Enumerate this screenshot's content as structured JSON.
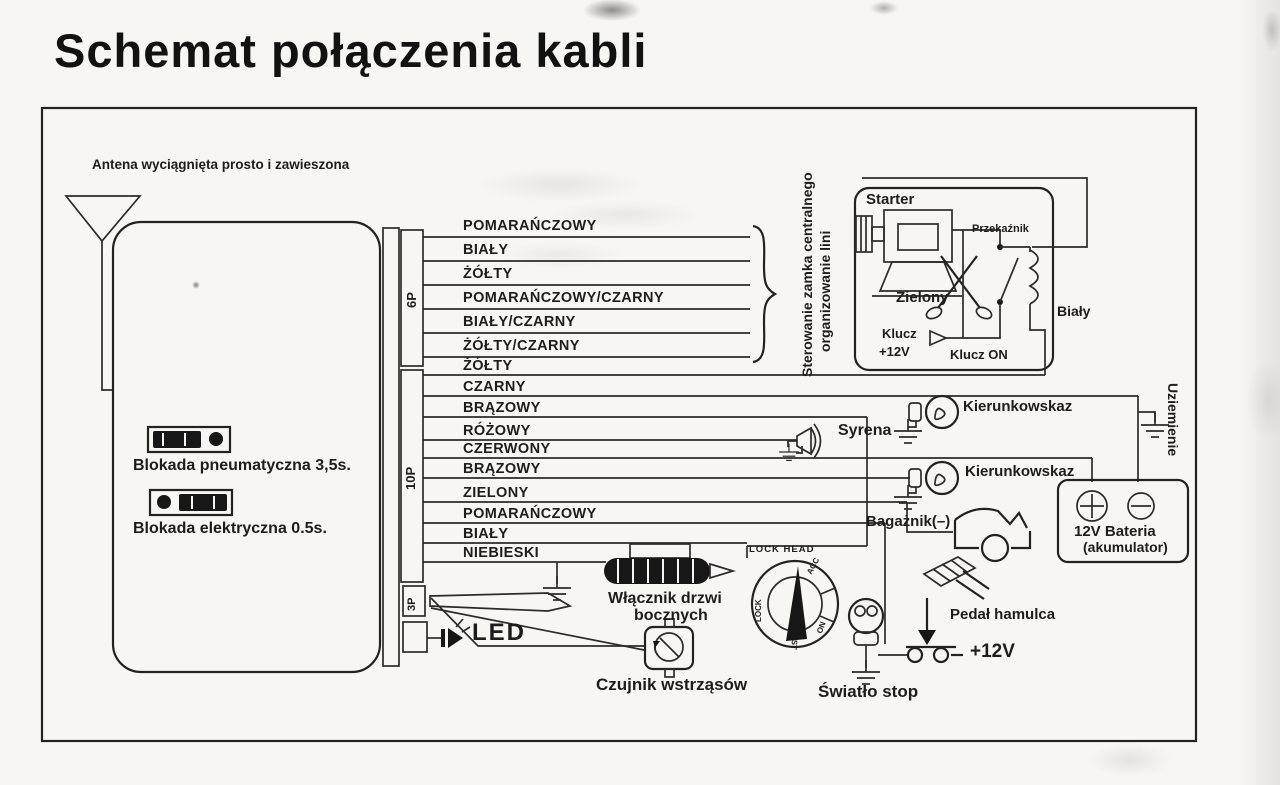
{
  "title": "Schemat połączenia kabli",
  "antenna_label": "Antena wyciągnięta prosto i zawieszona",
  "connectors": {
    "c6p": "6P",
    "c10p": "10P",
    "c3p": "3P"
  },
  "wires_6p": [
    "POMARAŃCZOWY",
    "BIAŁY",
    "ŻÓŁTY",
    "POMARAŃCZOWY/CZARNY",
    "BIAŁY/CZARNY",
    "ŻÓŁTY/CZARNY"
  ],
  "wires_10p": [
    "ŻÓŁTY",
    "CZARNY",
    "BRĄZOWY",
    "RÓŻOWY",
    "CZERWONY",
    "BRĄZOWY",
    "ZIELONY",
    "POMARAŃCZOWY",
    "BIAŁY",
    "NIEBIESKI"
  ],
  "brace_note": {
    "line1": "Sterowanie zamka centralnego",
    "line2": "organizowanie lini"
  },
  "starter_box": {
    "title": "Starter",
    "relay": "Przekaźnik",
    "green_wire": "Zielony",
    "key_line1": "Klucz",
    "key_line2": "+12V",
    "key_on": "Klucz ON",
    "white_wire": "Biały"
  },
  "labels": {
    "turn_signal_1": "Kierunkowskaz",
    "turn_signal_2": "Kierunkowskaz",
    "siren": "Syrena",
    "ground": "Uziemienie",
    "trunk": "Bagażnik(–)",
    "battery_line1": "12V Bateria",
    "battery_line2": "(akumulator)",
    "pneumatic_lock": "Blokada pneumatyczna 3,5s.",
    "electric_lock": "Blokada elektryczna 0.5s.",
    "side_door_line1": "Włącznik drzwi",
    "side_door_line2": "bocznych",
    "led": "LED",
    "shock_sensor": "Czujnik wstrząsów",
    "stop_light": "Światło stop",
    "brake_pedal": "Pedał hamulca",
    "plus_12v": "+12V",
    "lock_head": "LOCK HEAD",
    "lock_positions": {
      "lock": "LOCK",
      "acc": "ACC",
      "on": "ON",
      "st": "ST"
    }
  }
}
